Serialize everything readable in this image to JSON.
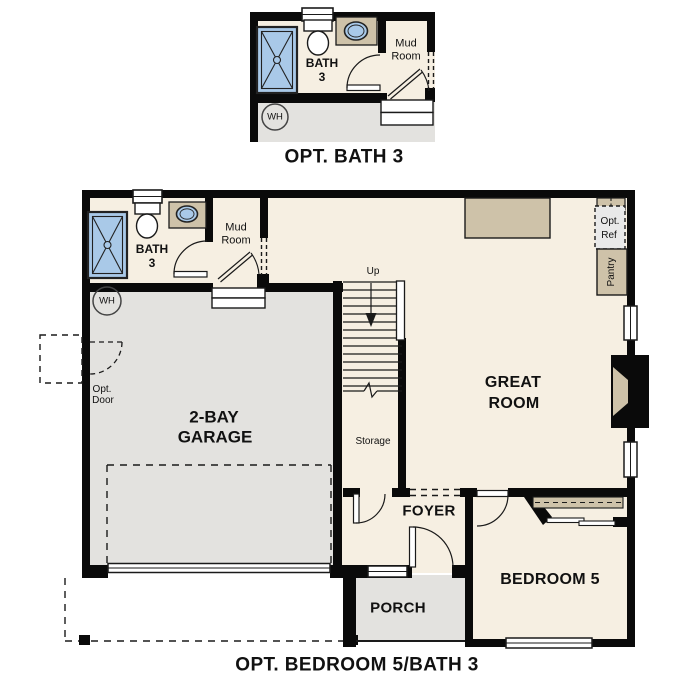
{
  "colors": {
    "floor": "#f6efe2",
    "garage": "#e3e2df",
    "tan": "#cec2a9",
    "blue": "#a9c9e8",
    "wall": "#0a0a0a",
    "optref": "#e9e9e9",
    "ink": "#111111"
  },
  "top_plan": {
    "title": "OPT. BATH 3",
    "rooms": {
      "bath_line1": "BATH",
      "bath_line2": "3",
      "mud_line1": "Mud",
      "mud_line2": "Room",
      "wh": "WH"
    }
  },
  "main_plan": {
    "title": "OPT. BEDROOM 5/BATH 3",
    "rooms": {
      "bath_line1": "BATH",
      "bath_line2": "3",
      "mud_line1": "Mud",
      "mud_line2": "Room",
      "wh": "WH",
      "up": "Up",
      "storage": "Storage",
      "great_line1": "GREAT",
      "great_line2": "ROOM",
      "garage_line1": "2-BAY",
      "garage_line2": "GARAGE",
      "opt_door_line1": "Opt.",
      "opt_door_line2": "Door",
      "opt_ref_line1": "Opt.",
      "opt_ref_line2": "Ref",
      "pantry": "Pantry",
      "foyer": "FOYER",
      "bedroom5": "BEDROOM 5",
      "porch": "PORCH"
    }
  }
}
